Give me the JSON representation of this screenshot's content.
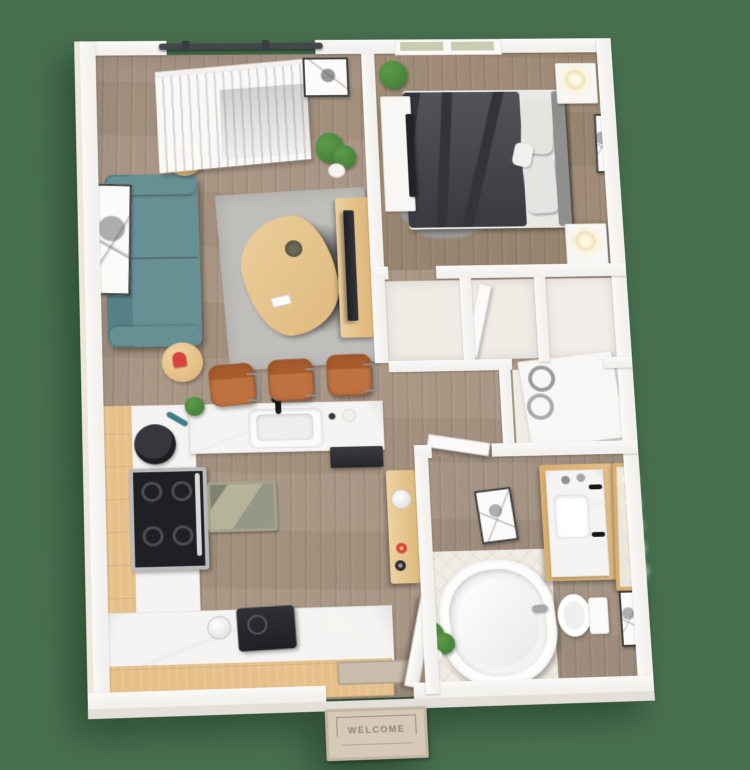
{
  "mat": {
    "label": "WELCOME"
  },
  "colors": {
    "background": "#47704E",
    "wall": "#F3F1ED",
    "wall_outer": "#EFE7DA",
    "wall_shade": "#E4E0D9",
    "floor_living": "#A79482",
    "floor_bedroom": "#9C8873",
    "floor_bath": "#A2917F",
    "tile": "#F0EBE3",
    "marble": "#F5F4F2",
    "wood": "#E5C089",
    "wood_deep": "#D9AE6F",
    "sofa": "#679095",
    "sofa_dark": "#558086",
    "rug_living": "#C0BEBA",
    "rug_bedroom": "#9B9C9E",
    "bed": "#44454B",
    "bed_dark": "#33343A",
    "pillow": "#E5E4E1",
    "headboard": "#8F8F8D",
    "stool": "#BF7240",
    "stool_dark": "#A85C2D",
    "appliance_dark": "#2B2C31",
    "steel": "#B9BABA",
    "plant": "#5E9B49",
    "plant_dark": "#3F7A33",
    "window_pane": "#C9CCB0",
    "door_track": "#42474C",
    "red_accent": "#D9453E",
    "mat_face": "#D7C9B8",
    "mat_border": "#9C8F7B",
    "mat_text_color": "#8D8173"
  }
}
